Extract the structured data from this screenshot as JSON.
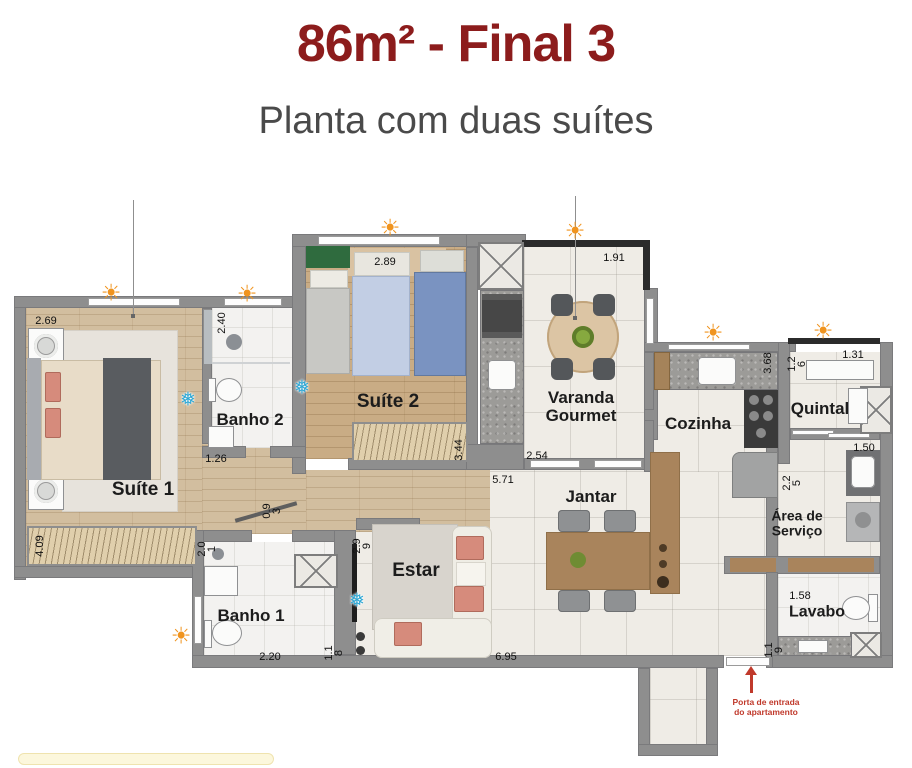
{
  "header": {
    "title": "86m² - Final 3",
    "subtitle": "Planta com duas suítes"
  },
  "plan": {
    "rooms": {
      "suite1": {
        "name": "Suíte 1",
        "dims": {
          "top": "2.69",
          "wardrobe": "4.09"
        }
      },
      "banho2": {
        "name": "Banho 2",
        "dims": {
          "width": "2.40",
          "door": "1.26"
        }
      },
      "suite2": {
        "name": "Suíte 2",
        "dims": {
          "top": "2.89",
          "right": "3.44"
        }
      },
      "varanda_gourmet": {
        "name": "Varanda\nGourmet",
        "dims": {
          "top": "1.91",
          "bottom": "2.54"
        }
      },
      "cozinha": {
        "name": "Cozinha",
        "dims": {
          "right": "3.68"
        }
      },
      "quintal": {
        "name": "Quintal",
        "dims": {
          "left": "1.2\n6",
          "top": "1.31"
        }
      },
      "area_servico": {
        "name": "Área de\nServiço",
        "dims": {
          "left": "2.2\n5",
          "sink": "1.50"
        }
      },
      "lavabo": {
        "name": "Lavabo",
        "dims": {
          "top": "1.58",
          "left": "1.1\n9"
        }
      },
      "banho1": {
        "name": "Banho 1",
        "dims": {
          "top": "2.0\n1",
          "bottom": "2.20"
        }
      },
      "estar": {
        "name": "Estar",
        "dims": {
          "left_top": "2.9\n9",
          "left_bottom": "1.1\n8",
          "bottom": "6.95"
        }
      },
      "jantar": {
        "name": "Jantar",
        "dims": {
          "top": "5.71"
        }
      },
      "hall": {
        "dims": {
          "wall": "0.9\n3"
        }
      }
    },
    "entry": {
      "label": "Porta de entrada\ndo apartamento"
    },
    "icons": {
      "sun": "☀",
      "snowflake": "❅"
    },
    "colors": {
      "title_red": "#8C1C1C",
      "subtitle_gray": "#4A4A4A",
      "wall_gray": "#8E8E8E",
      "sun_orange": "#F0941F",
      "snowflake_blue": "#2FA8D5",
      "entry_red": "#C0392B",
      "wood_floor": "#D2BE9F",
      "tile_floor": "#EFECE6"
    }
  }
}
